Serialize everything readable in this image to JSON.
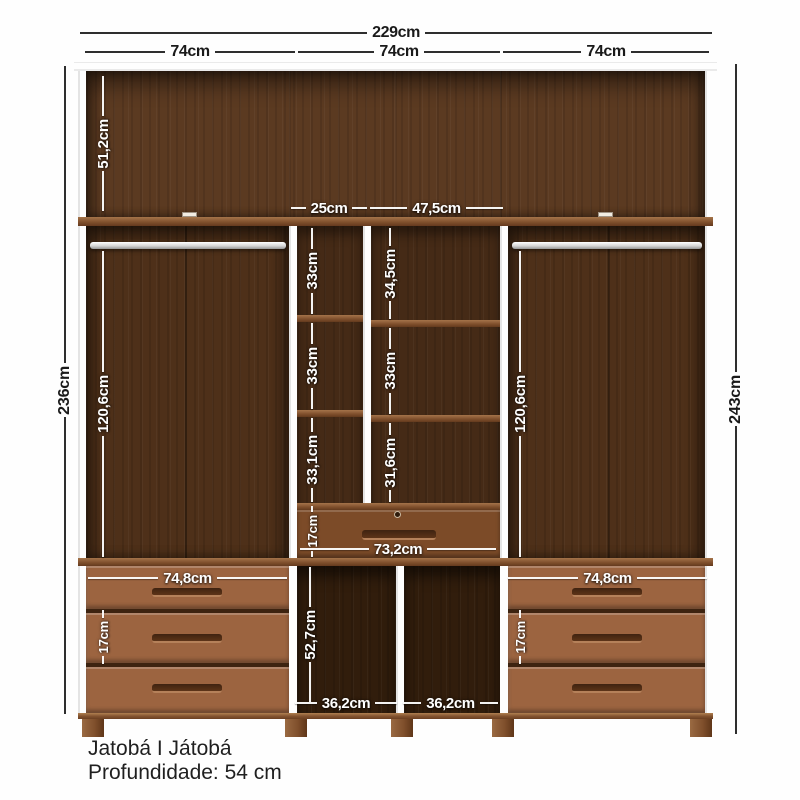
{
  "product": {
    "name": "Jatobá I Játobá",
    "depth": "Profundidade: 54 cm"
  },
  "dims": {
    "total_width": "229cm",
    "col_left": "74cm",
    "col_mid": "74cm",
    "col_right": "74cm",
    "height_body": "236cm",
    "height_total": "243cm",
    "top_shelf_h": "51,2cm",
    "nook_col_narrow": "25cm",
    "nook_col_wide": "47,5cm",
    "nook_l1": "33cm",
    "nook_l2": "33cm",
    "nook_l3": "33,1cm",
    "nook_r1": "34,5cm",
    "nook_r2": "33cm",
    "nook_r3": "31,6cm",
    "hang_left": "120,6cm",
    "hang_right": "120,6cm",
    "mid_drawer_h": "17cm",
    "mid_drawer_w": "73,2cm",
    "drawers_left_w": "74,8cm",
    "drawers_right_w": "74,8cm",
    "drawer_left_h": "17cm",
    "drawer_right_h": "17cm",
    "open_h": "52,7cm",
    "open_left_w": "36,2cm",
    "open_right_w": "36,2cm"
  },
  "colors": {
    "wood_frame": "#82522f",
    "wood_back": "#4e3019",
    "wood_dark_open": "#311d0c",
    "drawer_face": "#9c6440",
    "dim_outside": "#2e2e2e",
    "dim_inside": "#ffffff"
  }
}
